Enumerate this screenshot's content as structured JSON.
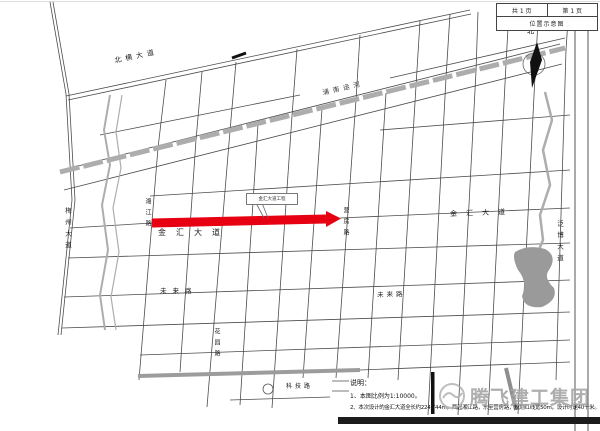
{
  "legend": {
    "page_total": "共 1 页",
    "page_num": "第 1 页",
    "title": "位置示意图"
  },
  "compass": {
    "north_label": "北"
  },
  "map_labels": {
    "north_avenue": "北横大道",
    "canal": "浦南运河",
    "jinhui_main": "金汇大道",
    "jinhui_east": "金汇大道",
    "future_west": "未来路",
    "future_east": "未来路",
    "meizhou_avenue": "梅州大道",
    "xiangjiang_road": "湘江路",
    "yingfang_road": "营房路",
    "fanbo_avenue": "泛博大道",
    "huayuan_road": "花园路",
    "keji_road": "科技路"
  },
  "callout": {
    "text": "金汇大道工程"
  },
  "notes": {
    "heading": "说明：",
    "line1": "1、本图比例为1:10000。",
    "line2": "2、本次设计的金汇大道全长约224.744m，西起湘江路，东至营房路，规划红线宽50m，设计时速40千米。"
  },
  "watermark": {
    "text": "腾飞建工集团"
  },
  "colors": {
    "highlight_red": "#e60012",
    "water_gray": "#a8a8a8"
  }
}
